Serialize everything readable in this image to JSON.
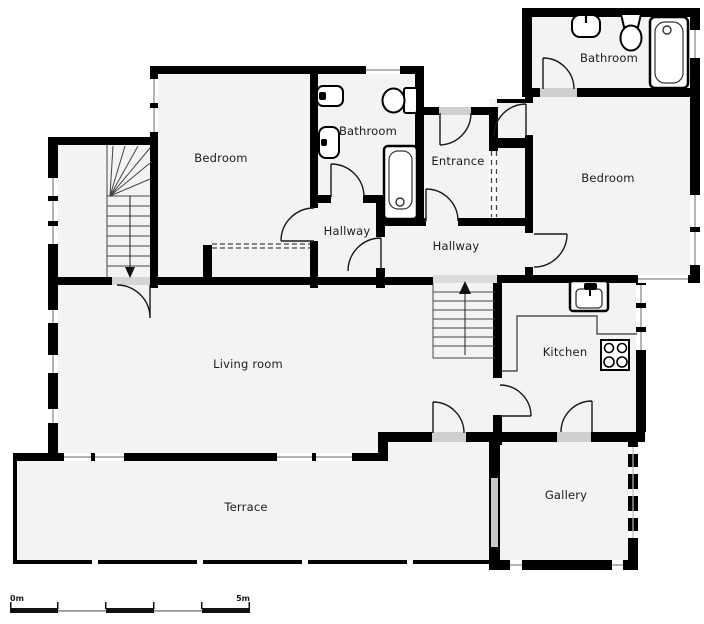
{
  "plan": {
    "rooms": {
      "bathroom_top_right": "Bathroom",
      "bedroom_right": "Bedroom",
      "bathroom_middle": "Bathroom",
      "entrance": "Entrance",
      "bedroom_left": "Bedroom",
      "hallway_left": "Hallway",
      "hallway_right": "Hallway",
      "living_room": "Living room",
      "kitchen": "Kitchen",
      "gallery": "Gallery",
      "terrace": "Terrace"
    },
    "scale_bar": {
      "start": "0m",
      "end": "5m"
    },
    "colors": {
      "wall": "#000000",
      "floor": "#f3f3f3",
      "door_line": "#1a1a1a",
      "window_line": "#9a9a9a",
      "threshold": "#cfcfcf"
    },
    "fixtures": [
      "bathtub",
      "toilet",
      "sink",
      "bidet",
      "kitchen-sink",
      "stove",
      "stairs",
      "wardrobe"
    ]
  }
}
